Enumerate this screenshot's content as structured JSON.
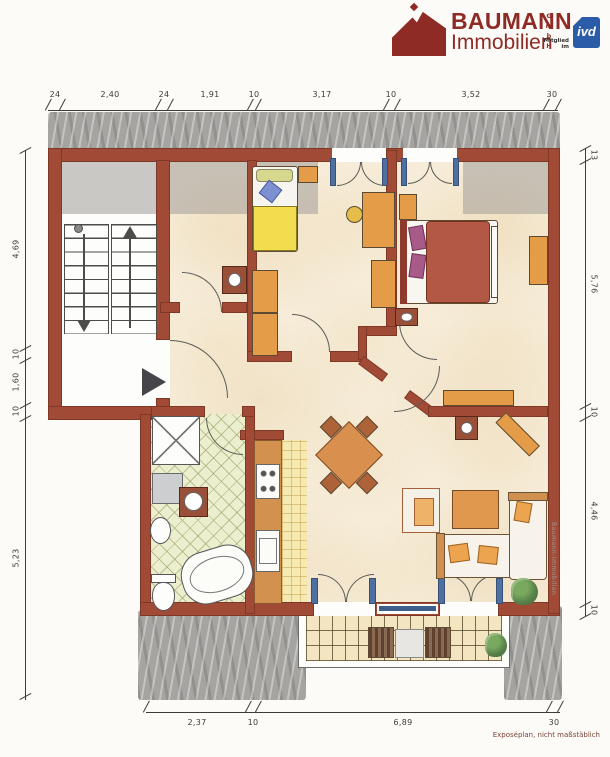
{
  "logo": {
    "brand_line1": "BAUMANN",
    "brand_line2": "Immobilien",
    "brand_suffix": "GmbH",
    "membership_label": "Mitglied im",
    "badge_text": "ivd"
  },
  "plan": {
    "watermark": "Baumann-Immobilien",
    "footnote": "Exposéplan, nicht maßstäblich"
  },
  "dimensions": {
    "top": [
      "24",
      "2,40",
      "24",
      "1,91",
      "10",
      "3,17",
      "10",
      "3,52",
      "30"
    ],
    "left": [
      "4,69",
      "10",
      "1,60",
      "10",
      "5,23"
    ],
    "right": [
      "13",
      "5,76",
      "10",
      "4,46",
      "10"
    ],
    "bottom": [
      "2,37",
      "10",
      "6,89",
      "30"
    ]
  },
  "colors": {
    "wall": "#a14b37",
    "accent_red": "#8e2b25",
    "badge_blue": "#2b5ca8",
    "furniture_orange": "#e59c48"
  }
}
